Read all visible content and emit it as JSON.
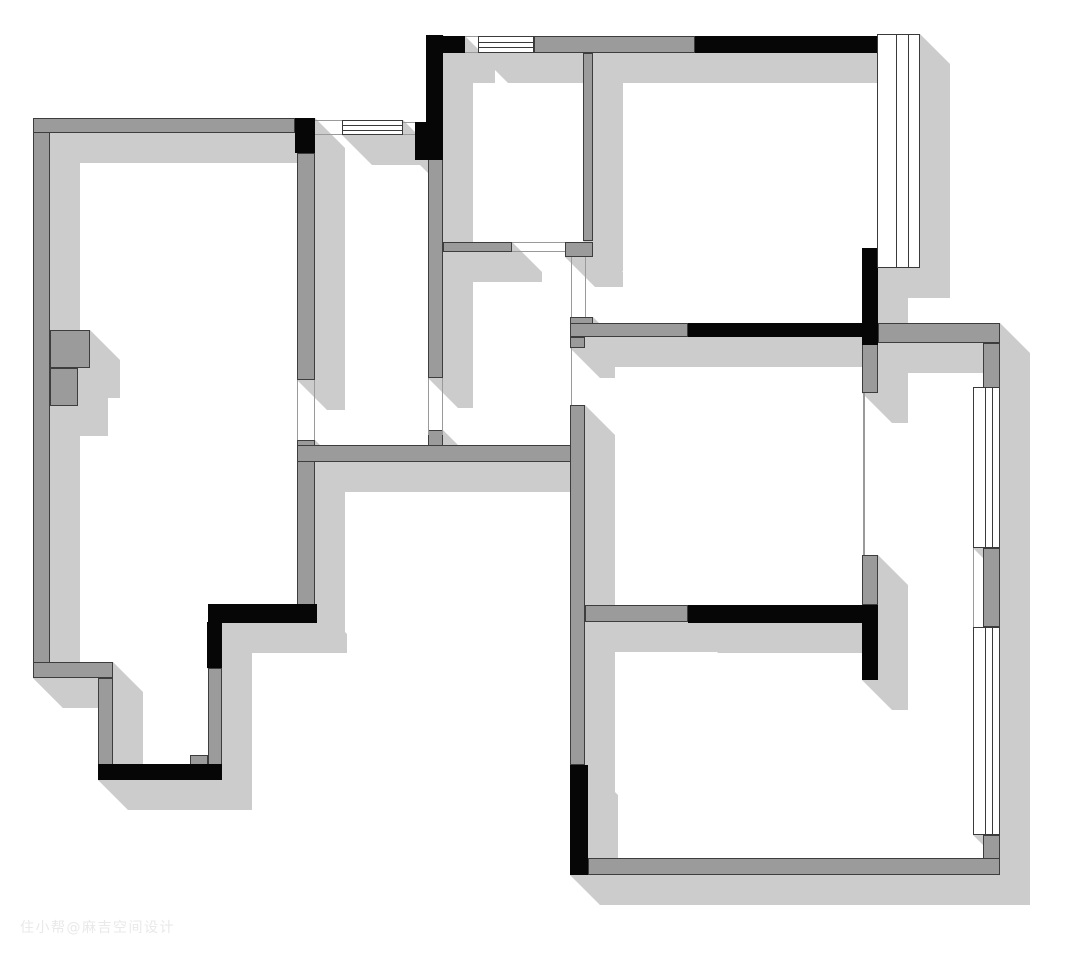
{
  "watermark": {
    "text": "住小帮@麻吉空间设计"
  },
  "palette": {
    "background": "#ffffff",
    "wall_gray": "#9b9b9b",
    "wall_outline": "#3d3d3d",
    "wall_black": "#060606",
    "shadow": "#cccccc",
    "window_fill": "#ffffff",
    "watermark_color": "#e9e9e9"
  },
  "plan": {
    "canvas_width": 1080,
    "canvas_height": 955,
    "shadow_offset": 30,
    "walls_gray": [
      [
        33,
        118,
        17,
        560
      ],
      [
        33,
        118,
        262,
        15
      ],
      [
        50,
        330,
        40,
        38
      ],
      [
        50,
        368,
        28,
        38
      ],
      [
        297,
        153,
        18,
        227
      ],
      [
        297,
        440,
        18,
        165
      ],
      [
        33,
        662,
        80,
        16
      ],
      [
        98,
        678,
        15,
        88
      ],
      [
        190,
        755,
        18,
        10
      ],
      [
        208,
        668,
        14,
        97
      ],
      [
        428,
        158,
        15,
        220
      ],
      [
        428,
        430,
        15,
        16
      ],
      [
        297,
        445,
        286,
        17
      ],
      [
        443,
        242,
        69,
        10
      ],
      [
        583,
        53,
        10,
        188
      ],
      [
        565,
        242,
        28,
        15
      ],
      [
        534,
        36,
        161,
        17
      ],
      [
        570,
        317,
        23,
        7
      ],
      [
        570,
        323,
        118,
        14
      ],
      [
        570,
        337,
        15,
        11
      ],
      [
        570,
        405,
        15,
        360
      ],
      [
        585,
        605,
        103,
        17
      ],
      [
        862,
        337,
        16,
        56
      ],
      [
        862,
        555,
        16,
        50
      ],
      [
        878,
        323,
        122,
        20
      ],
      [
        983,
        343,
        17,
        45
      ],
      [
        983,
        548,
        17,
        79
      ],
      [
        983,
        835,
        17,
        40
      ],
      [
        588,
        858,
        412,
        17
      ]
    ],
    "walls_black": [
      [
        295,
        118,
        20,
        35
      ],
      [
        426,
        35,
        17,
        125
      ],
      [
        443,
        36,
        22,
        17
      ],
      [
        415,
        122,
        11,
        38
      ],
      [
        695,
        36,
        182,
        17
      ],
      [
        862,
        248,
        16,
        97
      ],
      [
        878,
        248,
        29,
        20
      ],
      [
        688,
        323,
        174,
        14
      ],
      [
        688,
        605,
        190,
        18
      ],
      [
        862,
        605,
        16,
        75
      ],
      [
        208,
        604,
        109,
        19
      ],
      [
        207,
        622,
        15,
        46
      ],
      [
        98,
        764,
        124,
        16
      ],
      [
        570,
        765,
        18,
        110
      ]
    ],
    "windows": [
      {
        "x": 342,
        "y": 120,
        "w": 61,
        "h": 15,
        "orient": "h"
      },
      {
        "x": 478,
        "y": 36,
        "w": 56,
        "h": 17,
        "orient": "h"
      },
      {
        "x": 877,
        "y": 34,
        "w": 43,
        "h": 234,
        "orient": "v"
      },
      {
        "x": 973,
        "y": 387,
        "w": 27,
        "h": 161,
        "orient": "v"
      },
      {
        "x": 973,
        "y": 627,
        "w": 27,
        "h": 208,
        "orient": "v"
      }
    ],
    "opening_lines": [
      [
        297,
        380,
        1,
        60
      ],
      [
        314,
        380,
        1,
        60
      ],
      [
        428,
        378,
        1,
        57
      ],
      [
        442,
        378,
        1,
        57
      ],
      [
        512,
        242,
        53,
        1
      ],
      [
        512,
        251,
        53,
        1
      ],
      [
        571,
        257,
        1,
        60
      ],
      [
        585,
        257,
        1,
        60
      ],
      [
        571,
        348,
        1,
        57
      ],
      [
        863,
        393,
        2,
        162
      ],
      [
        973,
        548,
        1,
        79
      ],
      [
        315,
        120,
        27,
        1
      ],
      [
        315,
        134,
        27,
        1
      ],
      [
        403,
        122,
        12,
        1
      ],
      [
        403,
        134,
        12,
        1
      ],
      [
        465,
        36,
        13,
        1
      ],
      [
        465,
        52,
        13,
        1
      ]
    ]
  }
}
